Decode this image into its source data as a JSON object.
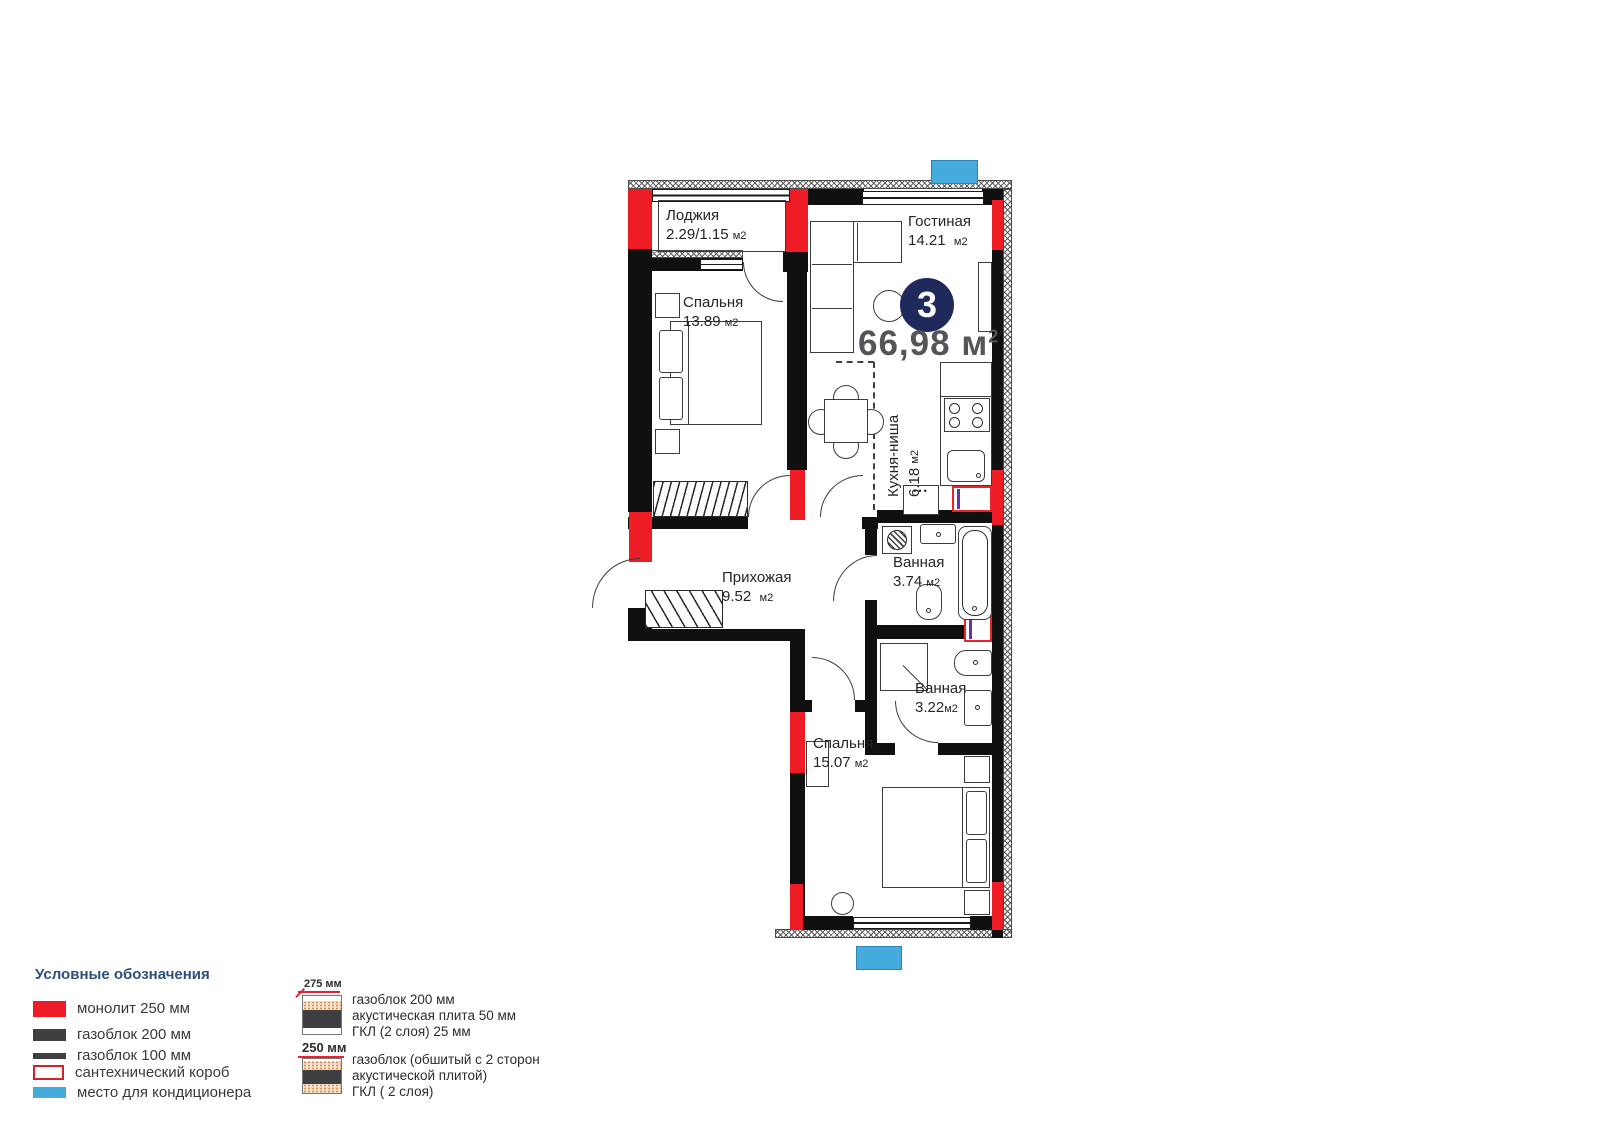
{
  "plan": {
    "unit_badge": "3",
    "total_area": "66,98",
    "total_area_unit": "м",
    "total_area_sup": "2",
    "kitchen_dots": "•••",
    "rooms": [
      {
        "id": "loggia",
        "name": "Лоджия",
        "area": "2.29/1.15",
        "unit": "м2"
      },
      {
        "id": "living",
        "name": "Гостиная",
        "area": "14.21",
        "unit": "м2"
      },
      {
        "id": "bedroom1",
        "name": "Спальня",
        "area": "13.89",
        "unit": "м2"
      },
      {
        "id": "kitchen",
        "name": "Кухня-ниша",
        "area": "6.18",
        "unit": "м2"
      },
      {
        "id": "hall",
        "name": "Прихожая",
        "area": "9.52",
        "unit": "м2"
      },
      {
        "id": "bath1",
        "name": "Ванная",
        "area": "3.74",
        "unit": "м2"
      },
      {
        "id": "bath2",
        "name": "Ванная",
        "area": "3.22",
        "unit": "м2"
      },
      {
        "id": "bedroom2",
        "name": "Спальня",
        "area": "15.07",
        "unit": "м2"
      }
    ]
  },
  "legend": {
    "title": "Условные обозначения",
    "items": [
      {
        "label": "монолит 250 мм"
      },
      {
        "label": "газоблок 200 мм"
      },
      {
        "label": "газоблок 100 мм"
      },
      {
        "label": "сантехнический короб"
      },
      {
        "label": "место для кондиционера"
      }
    ],
    "wall_samples": [
      {
        "dimension": "275 мм",
        "lines": [
          "газоблок 200 мм",
          "акустическая плита 50 мм",
          "ГКЛ (2 слоя) 25 мм"
        ]
      },
      {
        "dimension": "250 мм",
        "lines": [
          "газоблок (обшитый с 2 сторон",
          "акустической плитой)",
          "ГКЛ ( 2 слоя)"
        ]
      }
    ]
  },
  "colors": {
    "monolith_red": "#ee1c24",
    "ac_blue": "#45aadc",
    "badge_navy": "#20295c",
    "legend_heading": "#2d4f7e"
  }
}
